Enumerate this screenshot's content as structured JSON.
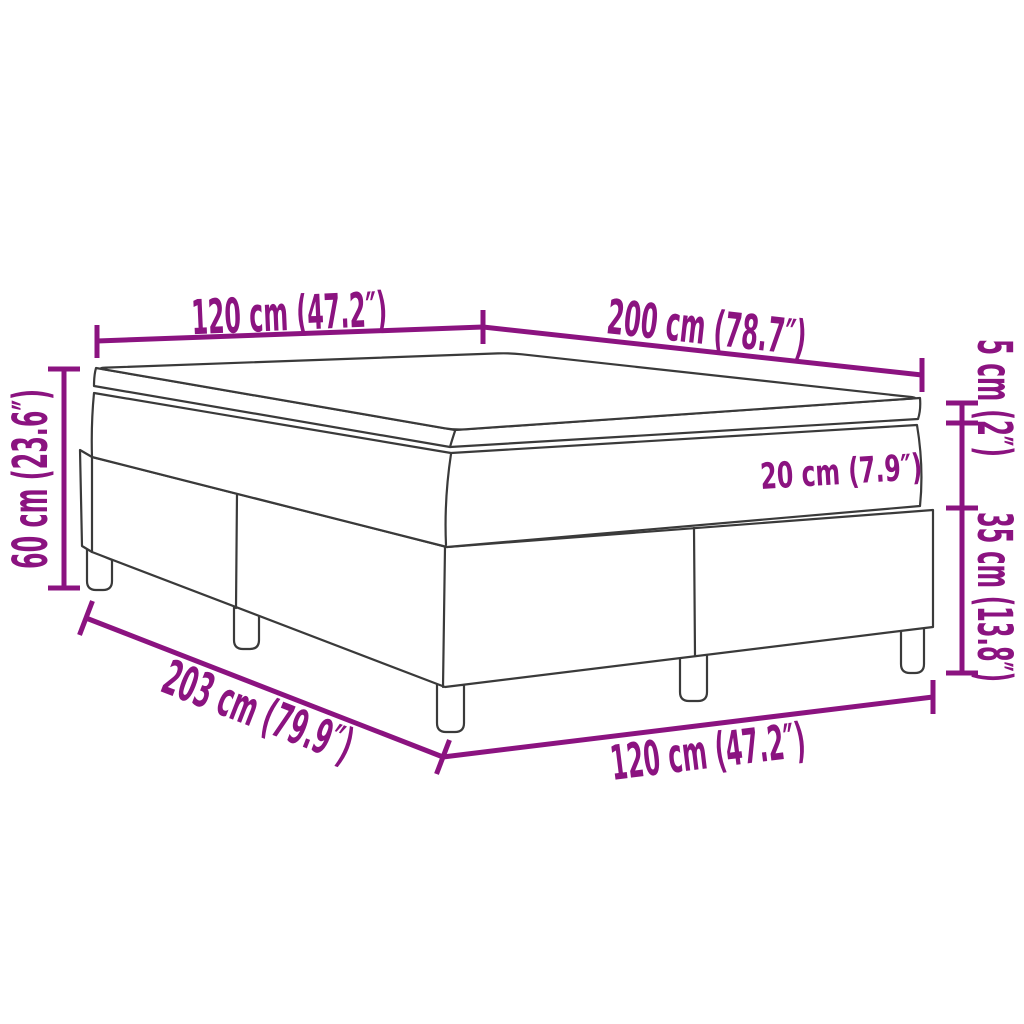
{
  "colors": {
    "dimension": "#8B1380",
    "drawing_line": "#3A3A3A",
    "background": "#FFFFFF"
  },
  "labels": {
    "top_width": "120 cm (47.2″)",
    "top_length": "200 cm (78.7″)",
    "topper_height": "5 cm (2″)",
    "mattress_height": "20 cm (7.9″)",
    "base_height": "35 cm (13.8″)",
    "total_height": "60 cm (23.6″)",
    "bottom_length": "203 cm (79.9″)",
    "bottom_width": "120 cm (47.2″)"
  }
}
